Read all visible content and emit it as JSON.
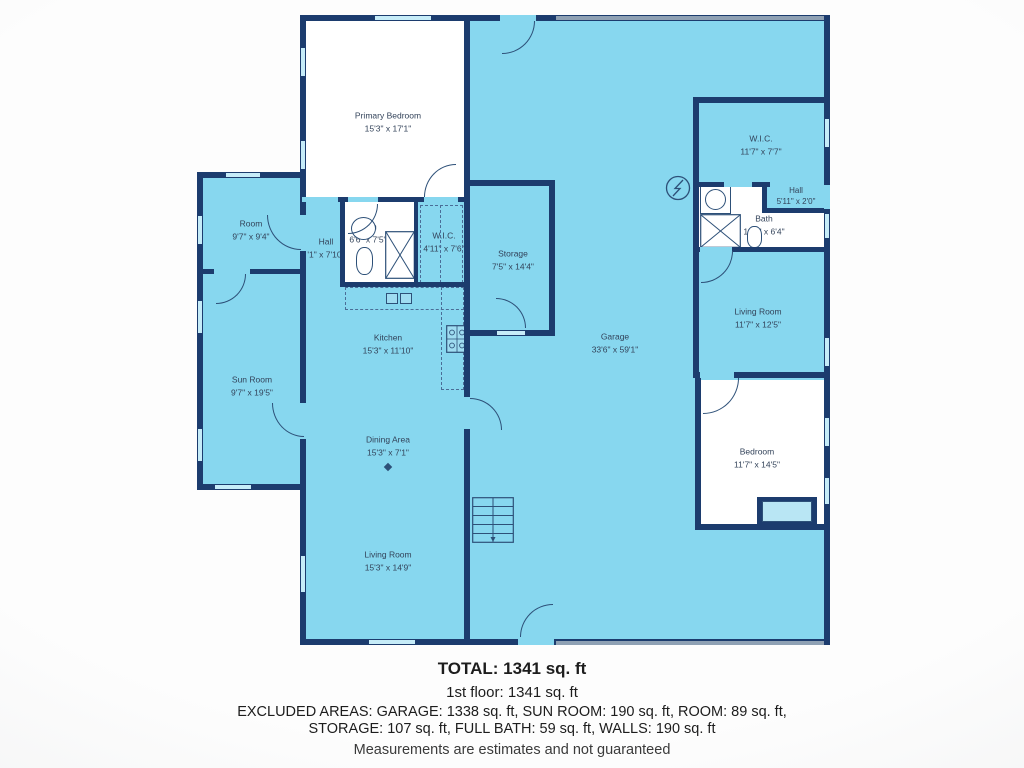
{
  "rooms": {
    "primary_bedroom": {
      "name": "Primary Bedroom",
      "dims": "15'3\" x 17'1\""
    },
    "room": {
      "name": "Room",
      "dims": "9'7\" x 9'4\""
    },
    "hall_left": {
      "name": "Hall",
      "dims": "'1\" x 7'10\""
    },
    "bath_left": {
      "name": "Bath",
      "dims": "6'6\" x 7'5\""
    },
    "wic_left": {
      "name": "W.I.C.",
      "dims": "4'11\" x 7'6\""
    },
    "storage": {
      "name": "Storage",
      "dims": "7'5\" x 14'4\""
    },
    "sun_room": {
      "name": "Sun Room",
      "dims": "9'7\" x 19'5\""
    },
    "kitchen": {
      "name": "Kitchen",
      "dims": "15'3\" x 11'10\""
    },
    "dining_area": {
      "name": "Dining Area",
      "dims": "15'3\" x 7'1\""
    },
    "living_room_left": {
      "name": "Living Room",
      "dims": "15'3\" x 14'9\""
    },
    "garage": {
      "name": "Garage",
      "dims": "33'6\" x 59'1\""
    },
    "wic_right": {
      "name": "W.I.C.",
      "dims": "11'7\" x 7'7\""
    },
    "hall_right": {
      "name": "Hall",
      "dims": "5'11\" x 2'0\""
    },
    "bath_right": {
      "name": "Bath",
      "dims": "11'7\" x 6'4\""
    },
    "living_room_right": {
      "name": "Living Room",
      "dims": "11'7\" x 12'5\""
    },
    "bedroom_right": {
      "name": "Bedroom",
      "dims": "11'7\" x 14'5\""
    }
  },
  "summary": {
    "total": "TOTAL: 1341 sq. ft",
    "floor_1": "1st floor: 1341 sq. ft",
    "excluded_line_1": "EXCLUDED AREAS: GARAGE: 1338 sq. ft, SUN ROOM: 190 sq. ft, ROOM: 89 sq. ft,",
    "excluded_line_2": "STORAGE: 107 sq. ft, FULL BATH: 59 sq. ft, WALLS: 190 sq. ft",
    "disclaimer": "Measurements are estimates and not guaranteed"
  },
  "colors": {
    "wall": "#1c3c6e",
    "floor": "#87d7ef",
    "window": "#c6ecf8",
    "white_room": "#ffffff",
    "garage_door": "#8fa1b4",
    "label_text": "#33435a"
  }
}
